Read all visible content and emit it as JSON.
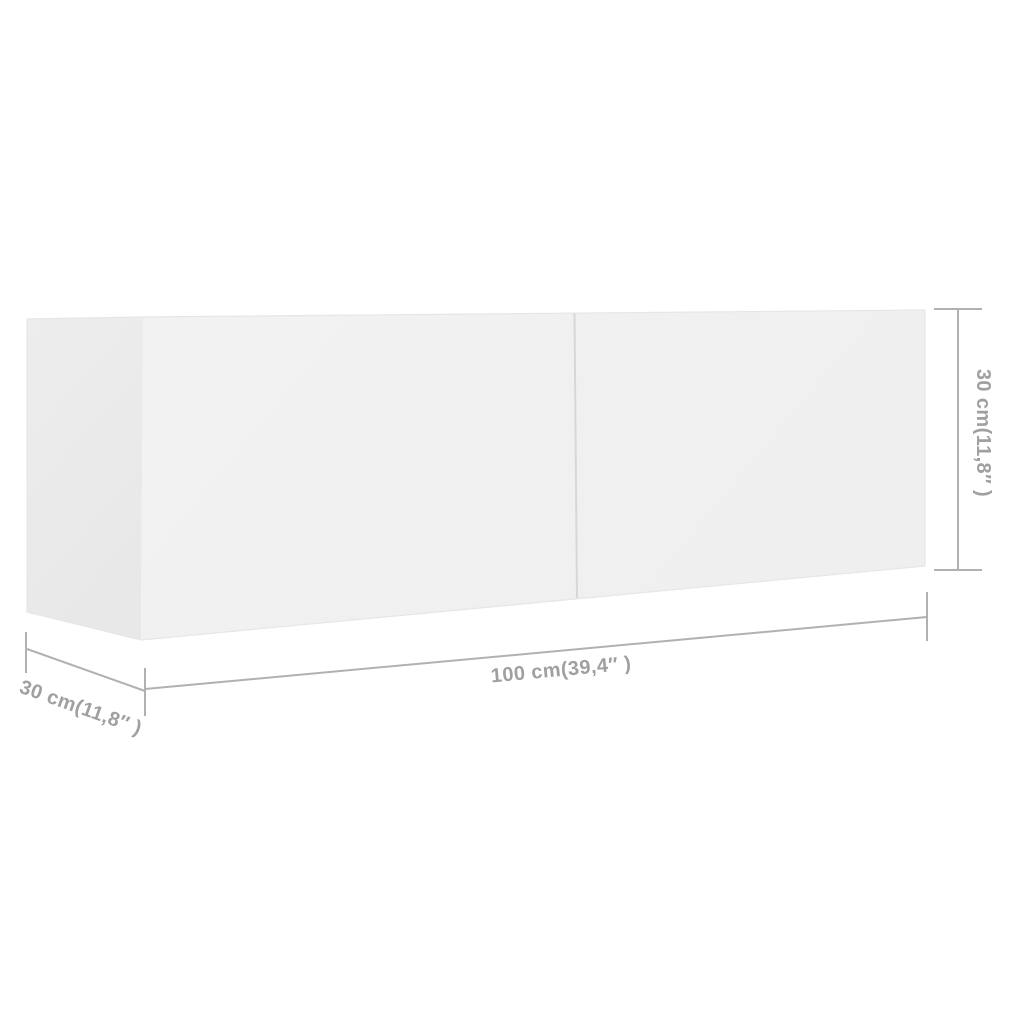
{
  "diagram": {
    "type": "product-dimension-diagram",
    "product": "tv-wall-cabinet",
    "background_color": "#ffffff",
    "labels": {
      "width": "100 cm(39,4″ )",
      "depth": "30 cm(11,8″ )",
      "height": "30 cm(11,8″ )"
    },
    "colors": {
      "front_face": "#f1f1f1",
      "side_face": "#ebebeb",
      "door_gap_line": "#d7d7d7",
      "dimension_line": "#b1b1b1",
      "dimension_text": "#a0a0a0",
      "edge": "#e6e6e6"
    }
  }
}
